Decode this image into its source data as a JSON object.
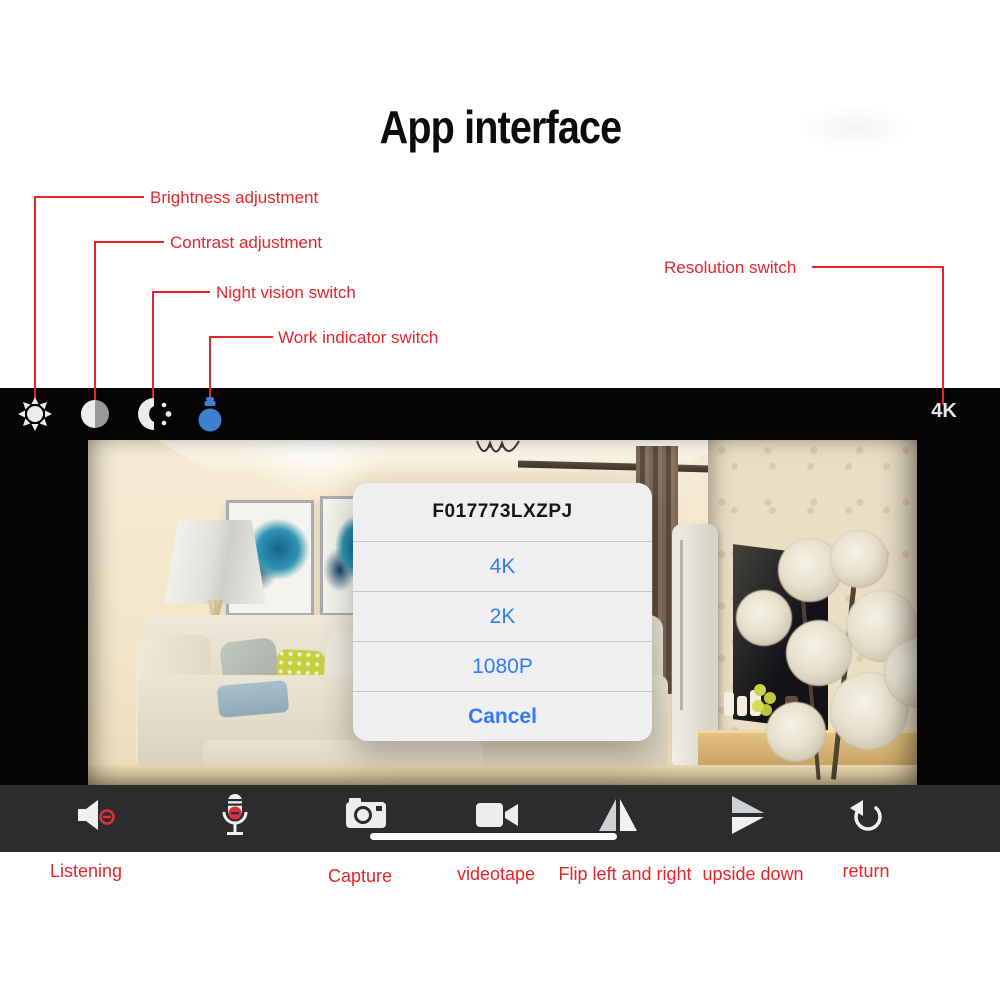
{
  "title": "App interface",
  "annotations": {
    "brightness": "Brightness adjustment",
    "contrast": "Contrast adjustment",
    "night_vision": "Night vision switch",
    "work_indicator": "Work indicator switch",
    "resolution": "Resolution switch"
  },
  "top_bar": {
    "resolution_value": "4K",
    "icons": [
      "brightness-sun",
      "contrast-circle",
      "night-vision",
      "work-indicator-bulb"
    ]
  },
  "dialog": {
    "title": "F017773LXZPJ",
    "options": [
      "4K",
      "2K",
      "1080P"
    ],
    "cancel_label": "Cancel"
  },
  "bottom_labels": {
    "listening": "Listening",
    "capture": "Capture",
    "videotape": "videotape",
    "flip": "Flip left and right",
    "upside_down": "upside down",
    "return": "return"
  },
  "colors": {
    "annotation_red": "#e8232b",
    "dialog_blue": "#2f7cf6",
    "bulb_blue": "#3f7fd2",
    "top_bar_bg": "#050505",
    "bottom_bar_bg": "#2c2c2e"
  }
}
